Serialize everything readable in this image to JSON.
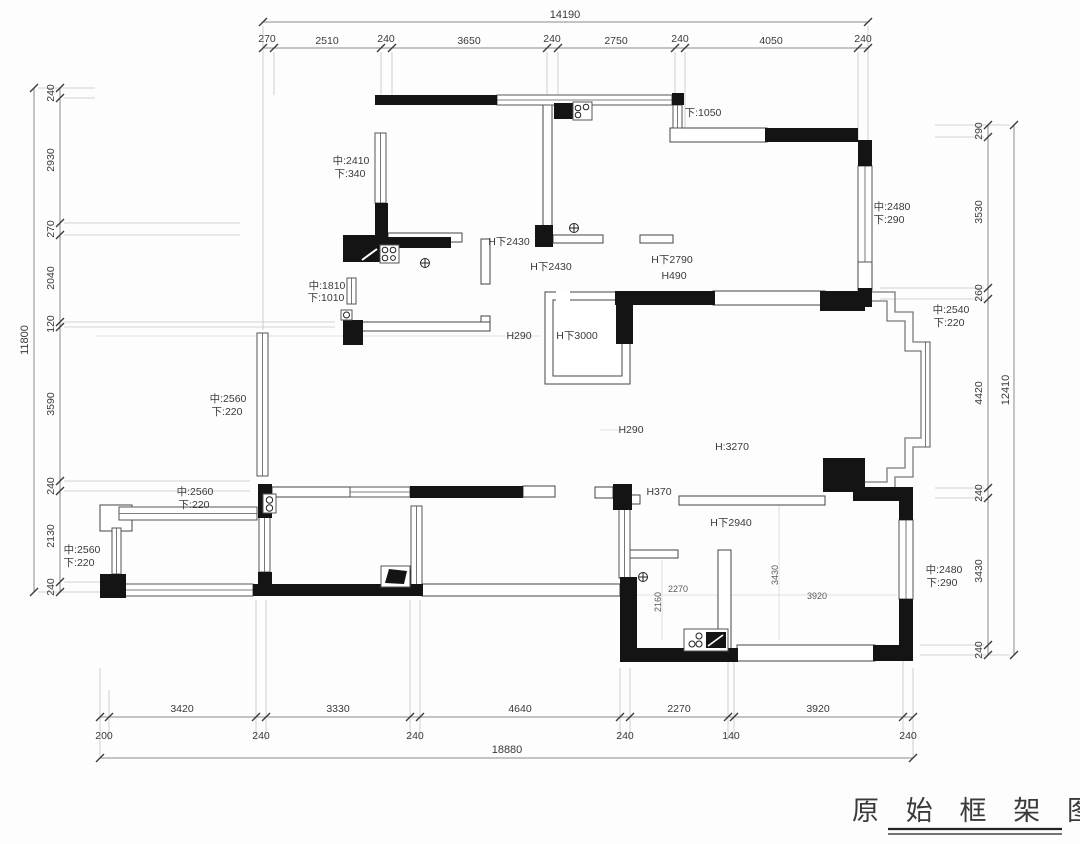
{
  "document_title": "原始框架图",
  "title_block": {
    "text": "原 始 框 架 图"
  },
  "dims": {
    "top_total": "14190",
    "top": [
      "270",
      "2510",
      "240",
      "3650",
      "240",
      "2750",
      "240",
      "4050",
      "240"
    ],
    "left_total": "11800",
    "left": [
      "240",
      "2930",
      "270",
      "2040",
      "120",
      "3590",
      "240",
      "2130",
      "240"
    ],
    "right_total": "12410",
    "right": [
      "290",
      "3530",
      "260",
      "4420",
      "240",
      "3430",
      "240"
    ],
    "bottom_total": "18880",
    "bottom_segments": [
      "3420",
      "3330",
      "4640",
      "2270",
      "3920"
    ],
    "bottom_walls": [
      "200",
      "240",
      "240",
      "240",
      "140",
      "240"
    ]
  },
  "annotations": [
    "中:2410",
    "下:340",
    "下:1050",
    "中:2480",
    "下:290",
    "H下2430",
    "H下2430",
    "H下2790",
    "H490",
    "中:1810",
    "下:1010",
    "H290",
    "H下3000",
    "中:2540",
    "下:220",
    "中:2560",
    "下:220",
    "H290",
    "H:3270",
    "中:2560",
    "下:220",
    "H370",
    "H下2940",
    "中:2560",
    "下:220",
    "中:2480",
    "下:290"
  ],
  "interior_dims": [
    "2270",
    "2160",
    "3430",
    "3920"
  ],
  "icons": [
    "gas-stove-icon",
    "gas-stove-icon",
    "floor-drain-icon",
    "floor-drain-icon",
    "floor-drain-icon",
    "washer-counter-icon",
    "tv-icon",
    "double-socket-icon",
    "doorbell-icon"
  ],
  "colors": {
    "wall": "#141414",
    "outline": "#444444",
    "dim_line": "#8a8a8a",
    "text": "#3a3a3a",
    "background": "#ffffff"
  }
}
